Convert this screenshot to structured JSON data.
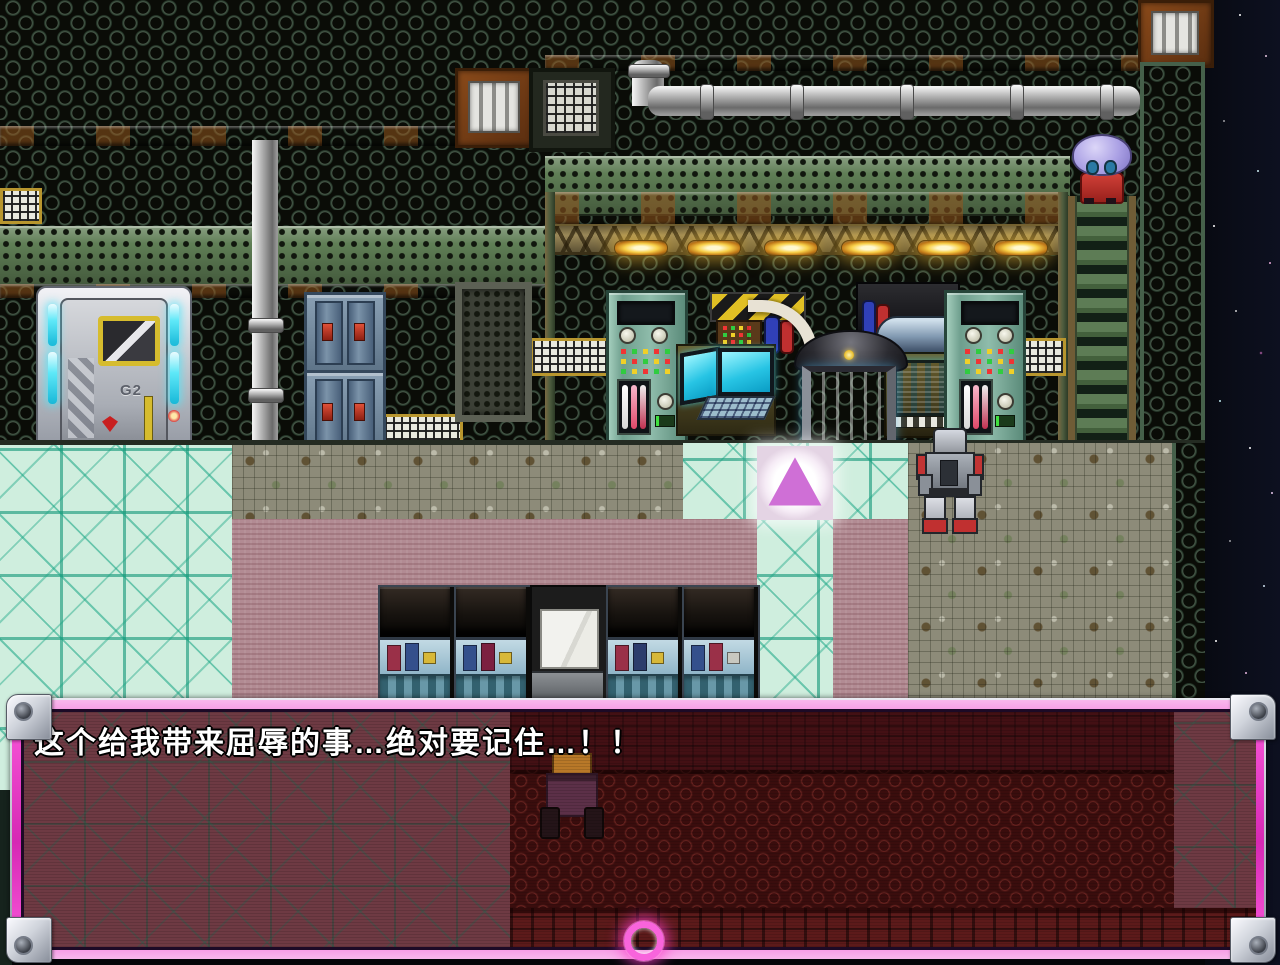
{
  "dialogue": {
    "text": "这个给我带来屈辱的事…绝对要记住…！！"
  },
  "door": {
    "label": "G2"
  },
  "icons": {
    "teleport": "teleport-triangle-icon",
    "continue": "continue-ring-icon"
  },
  "colors": {
    "dialog_frame_magenta": "#ee3ec8",
    "dialog_content_red": "#431014",
    "teleport_pink": "#cf6fd6",
    "screen_cyan": "#2ed0ec",
    "hazard_yellow": "#e0bf24",
    "floor_cyan": "#cfeede",
    "floor_mauve": "#b28b93",
    "wall_green": "#5f7e55",
    "night_sky": "#0a0d18",
    "ceiling_light_yellow": "#f8d048"
  }
}
